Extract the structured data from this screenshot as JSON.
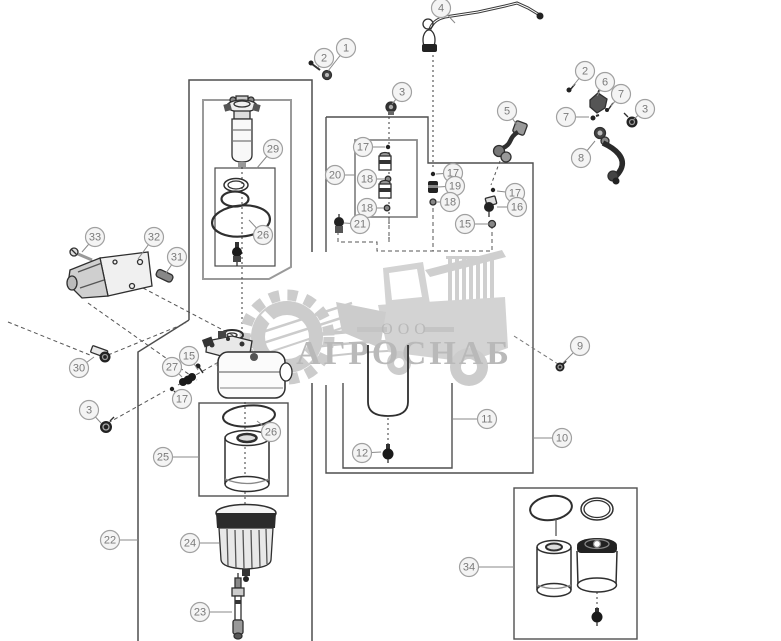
{
  "page": {
    "background": "#ffffff"
  },
  "watermark": {
    "prefix": "ООО",
    "name": "АГРОСНАБ",
    "color": "#b9b9b9",
    "logo_color": "#cccccc"
  },
  "diagram": {
    "line_color": "#3a3a3a",
    "box_color": "#4f4f4f",
    "inner_box_color": "#9a9a9a",
    "leader_color": "#8a8a8a",
    "balloon_fill": "#f4f4f4",
    "balloon_stroke": "#a0a0a0",
    "balloon_text": "#7a7a7a",
    "balloon_radius": 9.5,
    "callouts": [
      {
        "label": "1",
        "x": 346,
        "y": 48,
        "tx": 328,
        "ty": 71
      },
      {
        "label": "2",
        "x": 324,
        "y": 58,
        "tx": 318,
        "ty": 68
      },
      {
        "label": "4",
        "x": 441,
        "y": 8,
        "tx": 455,
        "ty": 23
      },
      {
        "label": "2",
        "x": 585,
        "y": 71,
        "tx": 573,
        "ty": 86
      },
      {
        "label": "6",
        "x": 605,
        "y": 82,
        "tx": 597,
        "ty": 96
      },
      {
        "label": "7",
        "x": 621,
        "y": 94,
        "tx": 611,
        "ty": 106
      },
      {
        "label": "3",
        "x": 645,
        "y": 109,
        "tx": 633,
        "ty": 120
      },
      {
        "label": "7",
        "x": 566,
        "y": 117,
        "tx": 589,
        "ty": 117
      },
      {
        "label": "8",
        "x": 581,
        "y": 158,
        "tx": 595,
        "ty": 141
      },
      {
        "label": "3",
        "x": 402,
        "y": 92,
        "tx": 392,
        "ty": 104
      },
      {
        "label": "5",
        "x": 507,
        "y": 111,
        "tx": 517,
        "ty": 125
      },
      {
        "label": "20",
        "x": 335,
        "y": 175,
        "tx": 355,
        "ty": 175
      },
      {
        "label": "17",
        "x": 363,
        "y": 147,
        "tx": 385,
        "ty": 147
      },
      {
        "label": "18",
        "x": 367,
        "y": 179,
        "tx": 385,
        "ty": 179
      },
      {
        "label": "18",
        "x": 367,
        "y": 208,
        "tx": 384,
        "ty": 208
      },
      {
        "label": "21",
        "x": 360,
        "y": 224,
        "tx": 344,
        "ty": 223
      },
      {
        "label": "17",
        "x": 453,
        "y": 173,
        "tx": 436,
        "ty": 174
      },
      {
        "label": "19",
        "x": 455,
        "y": 186,
        "tx": 438,
        "ty": 187
      },
      {
        "label": "18",
        "x": 450,
        "y": 202,
        "tx": 437,
        "ty": 202
      },
      {
        "label": "17",
        "x": 515,
        "y": 193,
        "tx": 497,
        "ty": 191
      },
      {
        "label": "16",
        "x": 517,
        "y": 207,
        "tx": 497,
        "ty": 207
      },
      {
        "label": "15",
        "x": 465,
        "y": 224,
        "tx": 489,
        "ty": 224
      },
      {
        "label": "9",
        "x": 580,
        "y": 346,
        "tx": 563,
        "ty": 363
      },
      {
        "label": "10",
        "x": 562,
        "y": 438,
        "tx": 533,
        "ty": 438
      },
      {
        "label": "11",
        "x": 487,
        "y": 419,
        "tx": 453,
        "ty": 419
      },
      {
        "label": "12",
        "x": 362,
        "y": 453,
        "tx": 381,
        "ty": 452
      },
      {
        "label": "29",
        "x": 273,
        "y": 149,
        "tx": 257,
        "ty": 168
      },
      {
        "label": "26",
        "x": 263,
        "y": 235,
        "tx": 249,
        "ty": 220
      },
      {
        "label": "33",
        "x": 95,
        "y": 237,
        "tx": 82,
        "ty": 252
      },
      {
        "label": "32",
        "x": 154,
        "y": 237,
        "tx": 138,
        "ty": 259
      },
      {
        "label": "31",
        "x": 177,
        "y": 257,
        "tx": 166,
        "ty": 273
      },
      {
        "label": "30",
        "x": 79,
        "y": 368,
        "tx": 94,
        "ty": 357
      },
      {
        "label": "3",
        "x": 89,
        "y": 410,
        "tx": 101,
        "ty": 423
      },
      {
        "label": "15",
        "x": 189,
        "y": 356,
        "tx": 198,
        "ty": 370
      },
      {
        "label": "27",
        "x": 172,
        "y": 367,
        "tx": 182,
        "ty": 377
      },
      {
        "label": "17",
        "x": 182,
        "y": 399,
        "tx": 175,
        "ty": 391
      },
      {
        "label": "22",
        "x": 110,
        "y": 540,
        "tx": 138,
        "ty": 540
      },
      {
        "label": "25",
        "x": 163,
        "y": 457,
        "tx": 199,
        "ty": 457
      },
      {
        "label": "24",
        "x": 190,
        "y": 543,
        "tx": 219,
        "ty": 543
      },
      {
        "label": "23",
        "x": 200,
        "y": 612,
        "tx": 232,
        "ty": 612
      },
      {
        "label": "26",
        "x": 271,
        "y": 432,
        "tx": 257,
        "ty": 421
      },
      {
        "label": "34",
        "x": 469,
        "y": 567,
        "tx": 514,
        "ty": 567
      }
    ]
  }
}
